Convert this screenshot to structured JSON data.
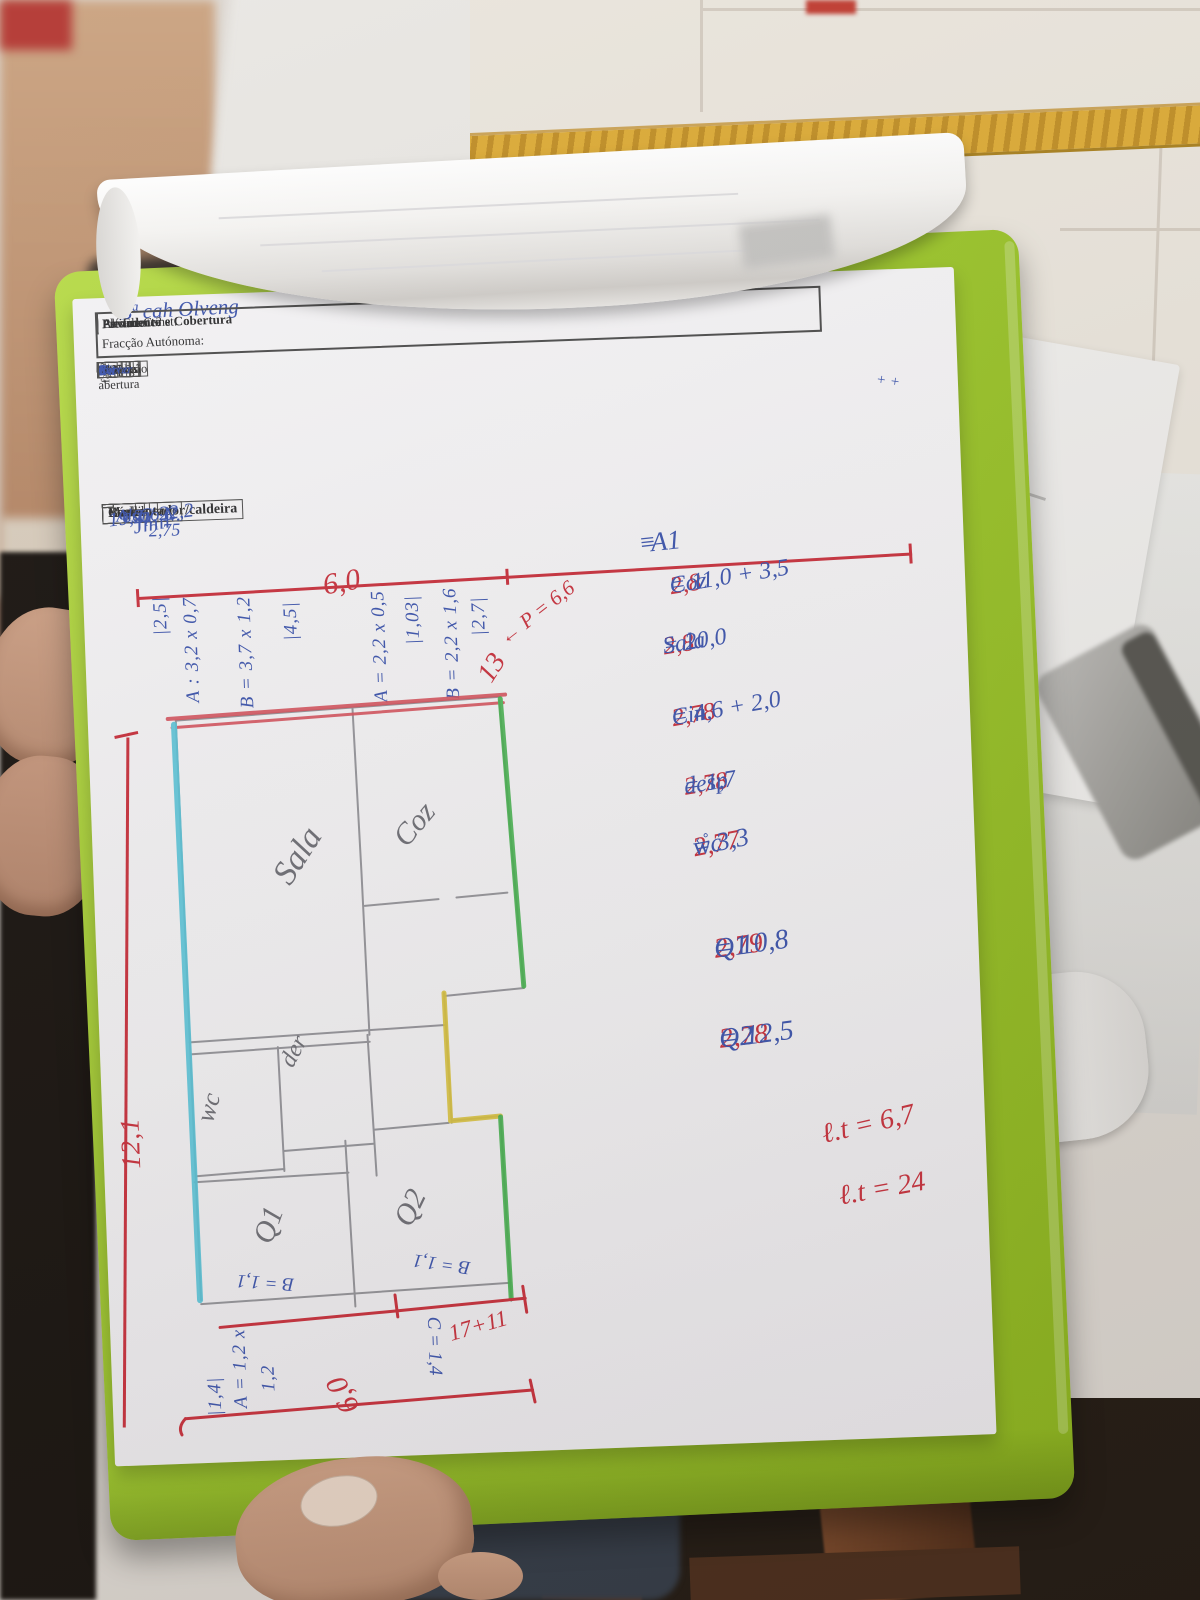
{
  "form": {
    "handwriting_top": "Bª cah Olveng",
    "fields": {
      "fracao": "Fracção Autónoma:",
      "ano": "Ano de Const:",
      "altitude": "Altitude:",
      "pre_frente": "Pré.Frente?",
      "elevador": "Elevador",
      "pavimento": "Pavimento e Cobertura"
    }
  },
  "windows_table": {
    "col_n": "Nº",
    "col_face": "face",
    "col_tipo": "Tipo abertura",
    "group_material": "Material",
    "group_vidro": "Vidro",
    "group_proteccao": "Protecção",
    "sub_alum": "Alum.",
    "sub_madei": "Madei",
    "sub_pvc": "PVC",
    "sub_simples": "Simples",
    "sub_duplo": "Duplo",
    "sub_ptipo": "Tipo",
    "sub_intext": "Int/Ext",
    "sub_cor": "Cor",
    "rows": [
      {
        "n": "A",
        "face": "e",
        "tipo": "Fixo",
        "alum": "x",
        "madei": "",
        "pvc": "",
        "simples": "α",
        "duplo": "",
        "ptipo": "S",
        "intext": "",
        "cor": ""
      },
      {
        "n": "B",
        "face": "J",
        "tipo": "Correr",
        "alum": "x",
        "madei": "",
        "pvc": "",
        "simples": "α",
        "duplo": "",
        "ptipo": "S",
        "intext": "",
        "cor": ""
      },
      {
        "n": "C",
        "face": "e",
        "tipo": "Corr.",
        "alum": "",
        "madei": "x",
        "pvc": "",
        "simples": "x",
        "duplo": "",
        "ptipo": "ext",
        "intext": "ext",
        "cor": "Ue"
      }
    ],
    "margin_marks": "+ +"
  },
  "heater_table": {
    "col_label": "Esquentador/caldeira",
    "col_marca": "Marca",
    "col_modelo": "Modelo",
    "col_idade": "Idade",
    "col_gas": "Gás",
    "col_rend": "Rendimento",
    "val_label": "esq",
    "val_marca": "Jmil",
    "val_modelo": "Alano C",
    "val_modelo2": "2,75",
    "val_gas": "G. N.",
    "val_rend": "19,2 / 22,2"
  },
  "calcs": {
    "a1_mark": "≡",
    "a1": "A1",
    "rows": [
      {
        "height": "2,8",
        "room": "Coz",
        "value": "= 11,0 + 3,5"
      },
      {
        "height": "2,8",
        "room": "Sala",
        "value": "= 20,0"
      },
      {
        "height": "2,78",
        "room": "Cin",
        "value": "= 4,6 + 2,0"
      },
      {
        "height": "2,78",
        "room": "desp",
        "value": "= 1,7"
      },
      {
        "height": "2,77",
        "room": "wc",
        "value": "= 3,3",
        "extra": "‹ °"
      },
      {
        "height": "2,79",
        "room": "Q1",
        "value": "= 10,8"
      },
      {
        "height": "2,78",
        "room": "Q2",
        "value": "= 12,5"
      }
    ],
    "totals": [
      "ℓ.t = 6,7",
      "ℓ.t = 24"
    ]
  },
  "plan": {
    "rooms": {
      "sala": "Sala",
      "coz": "Coz",
      "wc": "wc",
      "desp": "der",
      "q1": "Q1",
      "q2": "Q2"
    },
    "dims_top": [
      "|2,5|",
      "A : 3,2 x 0,7",
      "B = 3,7 x 1,2",
      "|4,5|",
      "A = 2,2 x 0,5",
      "|1,03|",
      "B = 2,2 x 1,6",
      "|2,7|"
    ],
    "dims_top_red": {
      "width": "6,0",
      "thirteen": "13",
      "perimeter": "← P = 6,6"
    },
    "left_height": "12,1",
    "dims_bottom_blue": [
      "B = 1,1",
      "B = 1,1",
      "C = 1,4",
      "A = 1,2 x",
      "1,2",
      "|1,4|"
    ],
    "dims_bottom_red": {
      "sum": "17+11",
      "width": "6,0"
    }
  },
  "colors": {
    "clipboard_green": "#9cc62b",
    "ink_blue": "#3d55ad",
    "ink_red": "#c8323e",
    "pencil": "#85858b"
  }
}
